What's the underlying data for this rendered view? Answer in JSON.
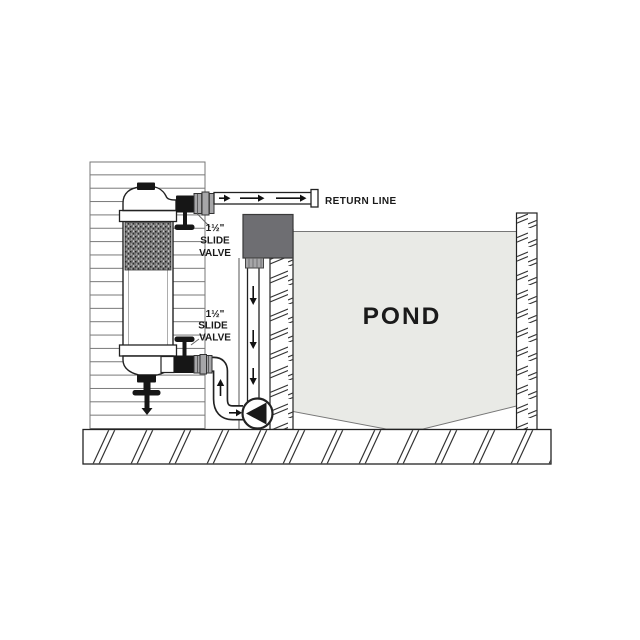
{
  "diagram": {
    "title": "pond-filter-plumbing-diagram",
    "labels": {
      "return_line": "RETURN LINE",
      "pond": "POND",
      "upper_valve": {
        "size": "1½\"",
        "line2": "SLIDE",
        "line3": "VALVE"
      },
      "lower_valve": {
        "size": "1½\"",
        "line2": "SLIDE",
        "line3": "VALVE"
      }
    },
    "colors": {
      "water": "#e9eae6",
      "skimmer_box": "#6e6e72",
      "fitting_gray": "#a6a6a8",
      "valve_dark": "#161616",
      "line": "#222222"
    }
  }
}
